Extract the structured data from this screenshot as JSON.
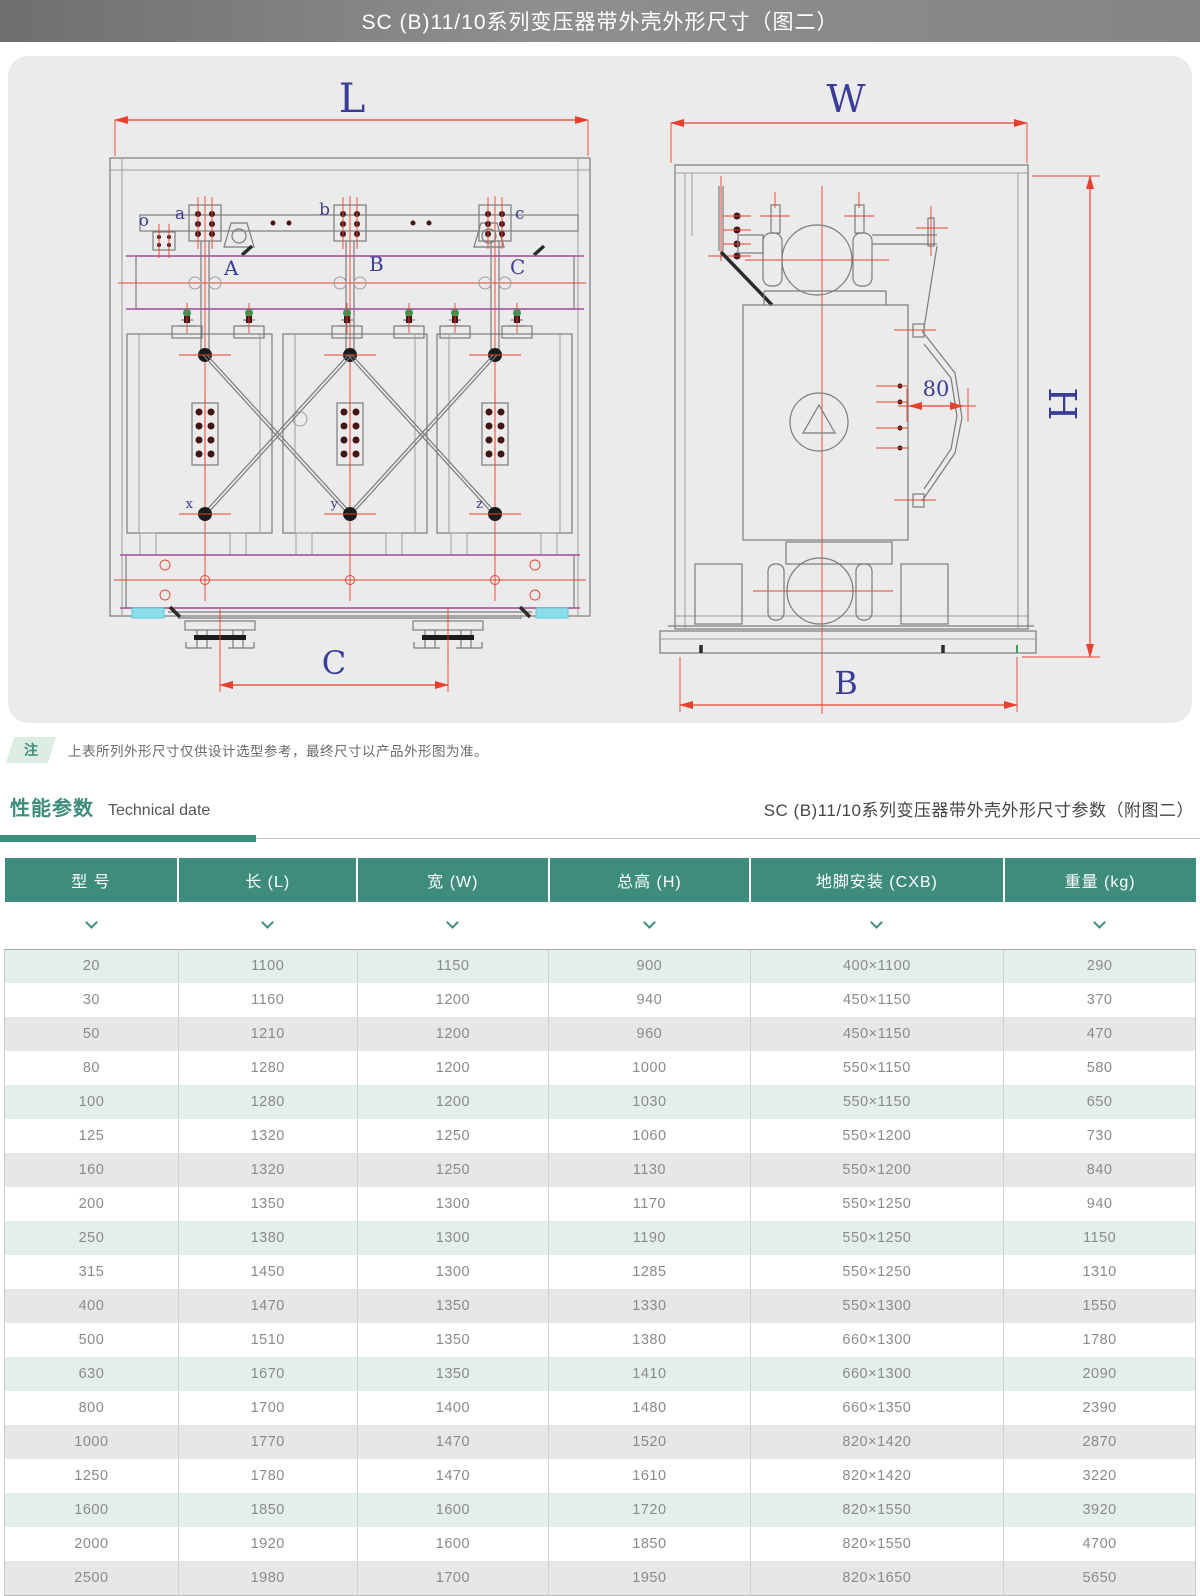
{
  "header": {
    "title": "SC (B)11/10系列变压器带外壳外形尺寸（图二）"
  },
  "note": {
    "badge": "注",
    "text": "上表所列外形尺寸仅供设计选型参考，最终尺寸以产品外形图为准。"
  },
  "section": {
    "title_cn": "性能参数",
    "title_en": "Technical date",
    "right_title": "SC (B)11/10系列变压器带外壳外形尺寸参数（附图二）"
  },
  "drawing": {
    "front": {
      "dim_top": "L",
      "dim_bottom": "C",
      "terminals": [
        "o",
        "a",
        "b",
        "c"
      ],
      "phases": [
        "A",
        "B",
        "C"
      ],
      "neutrals": [
        "x",
        "y",
        "z"
      ]
    },
    "side": {
      "dim_top": "W",
      "dim_right": "H",
      "dim_bottom": "B",
      "door_offset": "80"
    }
  },
  "table": {
    "columns": [
      "型 号",
      "长 (L)",
      "宽 (W)",
      "总高 (H)",
      "地脚安装 (CXB)",
      "重量 (kg)"
    ],
    "rows": [
      [
        "20",
        "1100",
        "1150",
        "900",
        "400×1100",
        "290"
      ],
      [
        "30",
        "1160",
        "1200",
        "940",
        "450×1150",
        "370"
      ],
      [
        "50",
        "1210",
        "1200",
        "960",
        "450×1150",
        "470"
      ],
      [
        "80",
        "1280",
        "1200",
        "1000",
        "550×1150",
        "580"
      ],
      [
        "100",
        "1280",
        "1200",
        "1030",
        "550×1150",
        "650"
      ],
      [
        "125",
        "1320",
        "1250",
        "1060",
        "550×1200",
        "730"
      ],
      [
        "160",
        "1320",
        "1250",
        "1130",
        "550×1200",
        "840"
      ],
      [
        "200",
        "1350",
        "1300",
        "1170",
        "550×1250",
        "940"
      ],
      [
        "250",
        "1380",
        "1300",
        "1190",
        "550×1250",
        "1150"
      ],
      [
        "315",
        "1450",
        "1300",
        "1285",
        "550×1250",
        "1310"
      ],
      [
        "400",
        "1470",
        "1350",
        "1330",
        "550×1300",
        "1550"
      ],
      [
        "500",
        "1510",
        "1350",
        "1380",
        "660×1300",
        "1780"
      ],
      [
        "630",
        "1670",
        "1350",
        "1410",
        "660×1300",
        "2090"
      ],
      [
        "800",
        "1700",
        "1400",
        "1480",
        "660×1350",
        "2390"
      ],
      [
        "1000",
        "1770",
        "1470",
        "1520",
        "820×1420",
        "2870"
      ],
      [
        "1250",
        "1780",
        "1470",
        "1610",
        "820×1420",
        "3220"
      ],
      [
        "1600",
        "1850",
        "1600",
        "1720",
        "820×1550",
        "3920"
      ],
      [
        "2000",
        "1920",
        "1600",
        "1850",
        "820×1550",
        "4700"
      ],
      [
        "2500",
        "1980",
        "1700",
        "1950",
        "820×1650",
        "5650"
      ]
    ]
  },
  "colors": {
    "accent_green": "#3e8c7c",
    "table_header_bg": "#3e8c7c",
    "row_green": "#e4efe9",
    "row_gray": "#e7e7e7",
    "dim_red": "#e8402e",
    "label_navy": "#3a3d96",
    "titlebar_gray": "#828282"
  }
}
